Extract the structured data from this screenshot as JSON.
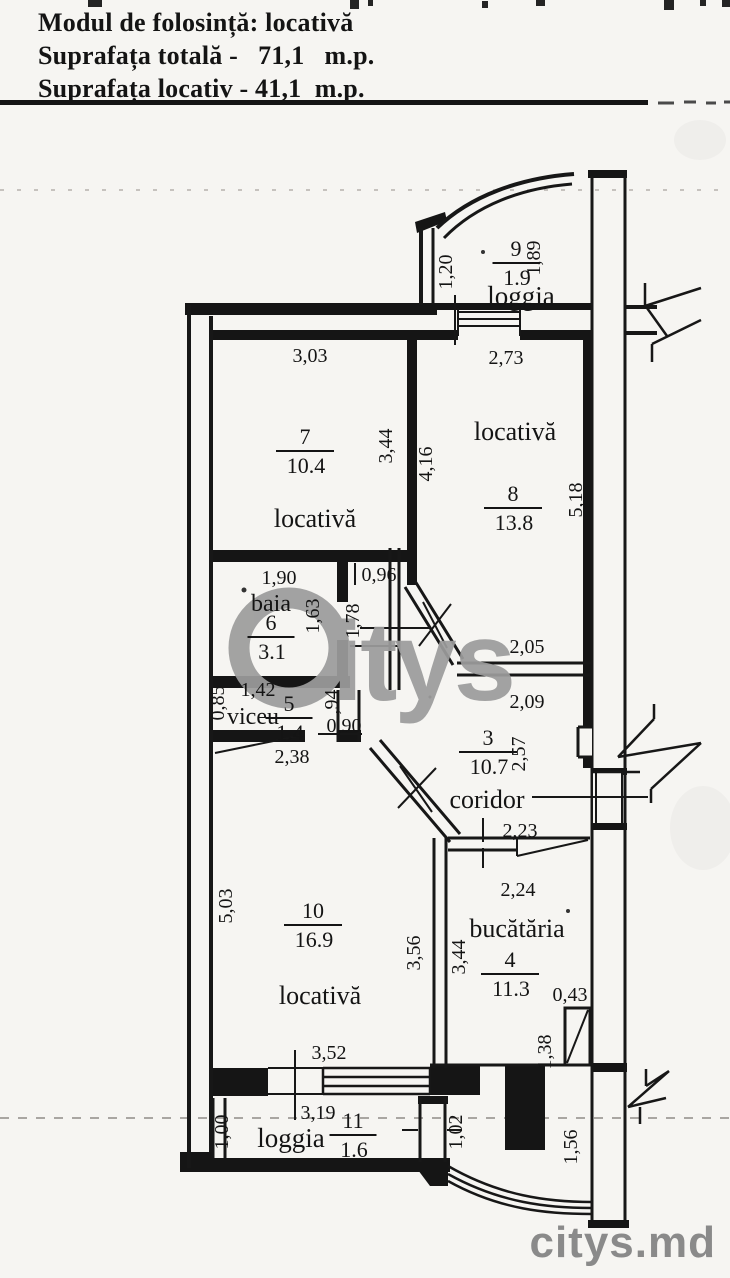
{
  "header": {
    "line1": "Modul de folosință: locativă",
    "line2": "Suprafața totală -   71,1   m.p.",
    "line3": "Suprafața locativ - 41,1  m.p."
  },
  "watermark": {
    "text": "itys",
    "color": "#9c9c9c"
  },
  "brand": {
    "text": "citys.md",
    "color": "#8a8a8a"
  },
  "plan": {
    "rooms": [
      {
        "id": "9",
        "number": "9",
        "area": "1.9",
        "name": "loggia",
        "cx": 516,
        "cy": 256,
        "nx": 521,
        "ny": 305,
        "nsize": 27
      },
      {
        "id": "7",
        "number": "7",
        "area": "10.4",
        "name": "locativă",
        "cx": 305,
        "cy": 444,
        "nx": 315,
        "ny": 527,
        "nsize": 26
      },
      {
        "id": "8",
        "number": "8",
        "area": "13.8",
        "name": "locativă",
        "cx": 513,
        "cy": 501,
        "nx": 515,
        "ny": 440,
        "nsize": 26
      },
      {
        "id": "6",
        "number": "6",
        "area": "3.1",
        "name": "baia",
        "cx": 271,
        "cy": 630,
        "nx": 271,
        "ny": 611,
        "nsize": 24
      },
      {
        "id": "5",
        "number": "5",
        "area": "1.4",
        "name": "viceu",
        "cx": 289,
        "cy": 711,
        "nx": 253,
        "ny": 724,
        "nsize": 24
      },
      {
        "id": "3",
        "number": "3",
        "area": "10.7",
        "name": "coridor",
        "cx": 488,
        "cy": 745,
        "nx": 487,
        "ny": 808,
        "nsize": 26
      },
      {
        "id": "10",
        "number": "10",
        "area": "16.9",
        "name": "locativă",
        "cx": 313,
        "cy": 918,
        "nx": 320,
        "ny": 1004,
        "nsize": 26
      },
      {
        "id": "4",
        "number": "4",
        "area": "11.3",
        "name": "bucătăria",
        "cx": 510,
        "cy": 967,
        "nx": 517,
        "ny": 937,
        "nsize": 26
      },
      {
        "id": "11",
        "number": "11",
        "area": "1.6",
        "name": "loggia",
        "cx": 353,
        "cy": 1128,
        "nx": 291,
        "ny": 1147,
        "nsize": 27
      }
    ],
    "dimensions": [
      {
        "t": "3,03",
        "x": 310,
        "y": 362,
        "r": 0
      },
      {
        "t": "2,73",
        "x": 506,
        "y": 364,
        "r": 0
      },
      {
        "t": "1,20",
        "x": 452,
        "y": 272,
        "r": -90
      },
      {
        "t": "1,89",
        "x": 540,
        "y": 258,
        "r": -90
      },
      {
        "t": "3,44",
        "x": 392,
        "y": 446,
        "r": -90
      },
      {
        "t": "4,16",
        "x": 432,
        "y": 464,
        "r": -90
      },
      {
        "t": "5,18",
        "x": 582,
        "y": 500,
        "r": -90
      },
      {
        "t": "1,90",
        "x": 279,
        "y": 584,
        "r": 0
      },
      {
        "t": "0,96",
        "x": 379,
        "y": 581,
        "r": 0
      },
      {
        "t": "1,63",
        "x": 319,
        "y": 616,
        "r": -90
      },
      {
        "t": "1,78",
        "x": 359,
        "y": 621,
        "r": -90
      },
      {
        "t": "2,05",
        "x": 527,
        "y": 653,
        "r": 0
      },
      {
        "t": "2,09",
        "x": 527,
        "y": 708,
        "r": 0
      },
      {
        "t": "2,57",
        "x": 525,
        "y": 754,
        "r": -90
      },
      {
        "t": "0,85",
        "x": 224,
        "y": 703,
        "r": -90
      },
      {
        "t": "1,42",
        "x": 258,
        "y": 696,
        "r": 0
      },
      {
        "t": ",94",
        "x": 338,
        "y": 702,
        "r": -90
      },
      {
        "t": "0,90",
        "x": 344,
        "y": 732,
        "r": 0
      },
      {
        "t": "2,38",
        "x": 292,
        "y": 763,
        "r": 0
      },
      {
        "t": "2,23",
        "x": 520,
        "y": 837,
        "r": 0
      },
      {
        "t": "2,24",
        "x": 518,
        "y": 896,
        "r": 0
      },
      {
        "t": "5,03",
        "x": 232,
        "y": 906,
        "r": -90
      },
      {
        "t": "3,56",
        "x": 420,
        "y": 953,
        "r": -90
      },
      {
        "t": "3,44",
        "x": 465,
        "y": 957,
        "r": -90
      },
      {
        "t": "0,43",
        "x": 570,
        "y": 1001,
        "r": 0
      },
      {
        "t": "1,38",
        "x": 551,
        "y": 1052,
        "r": -90
      },
      {
        "t": "3,52",
        "x": 329,
        "y": 1059,
        "r": 0
      },
      {
        "t": "3,19",
        "x": 318,
        "y": 1119,
        "r": 0
      },
      {
        "t": "1,00",
        "x": 228,
        "y": 1132,
        "r": -90
      },
      {
        "t": "1,02",
        "x": 462,
        "y": 1132,
        "r": -90
      },
      {
        "t": "1,56",
        "x": 577,
        "y": 1147,
        "r": -90
      }
    ]
  }
}
